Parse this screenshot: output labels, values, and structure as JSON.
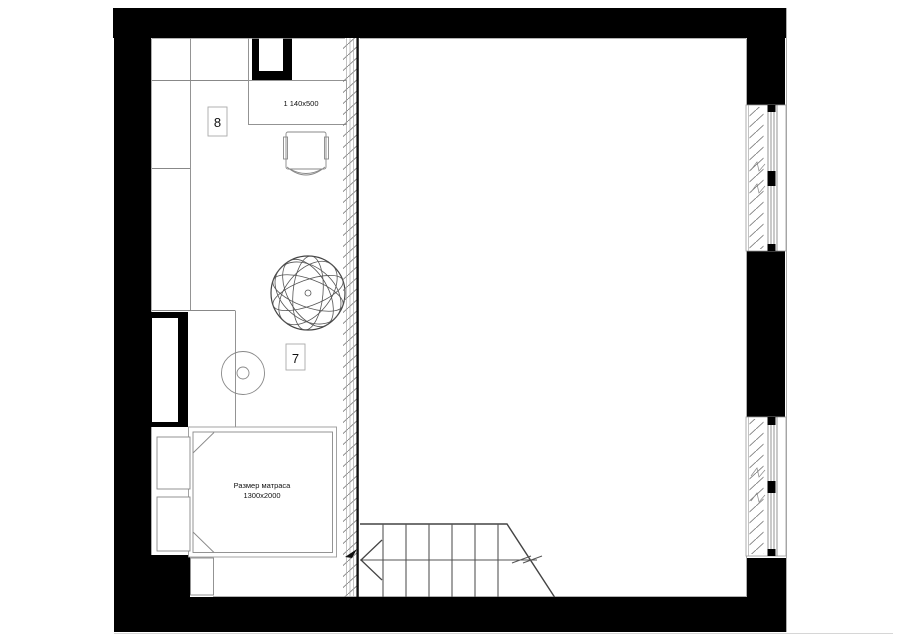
{
  "title": "Floor plan — bedroom level with stairs",
  "colors": {
    "wall_fill": "#000000",
    "line_dark": "#444444",
    "line_mid": "#888888",
    "line_light": "#bbbbbb",
    "background": "#ffffff"
  },
  "rooms": {
    "room_upper_label": "8",
    "room_lower_label": "7"
  },
  "desk": {
    "dimension": "1 140x500"
  },
  "bed": {
    "caption_line1": "Размер матраса",
    "caption_line2": "1300x2000"
  },
  "stairs": {
    "tread_lines": 6,
    "direction": "left"
  },
  "windows": {
    "count": 2
  }
}
